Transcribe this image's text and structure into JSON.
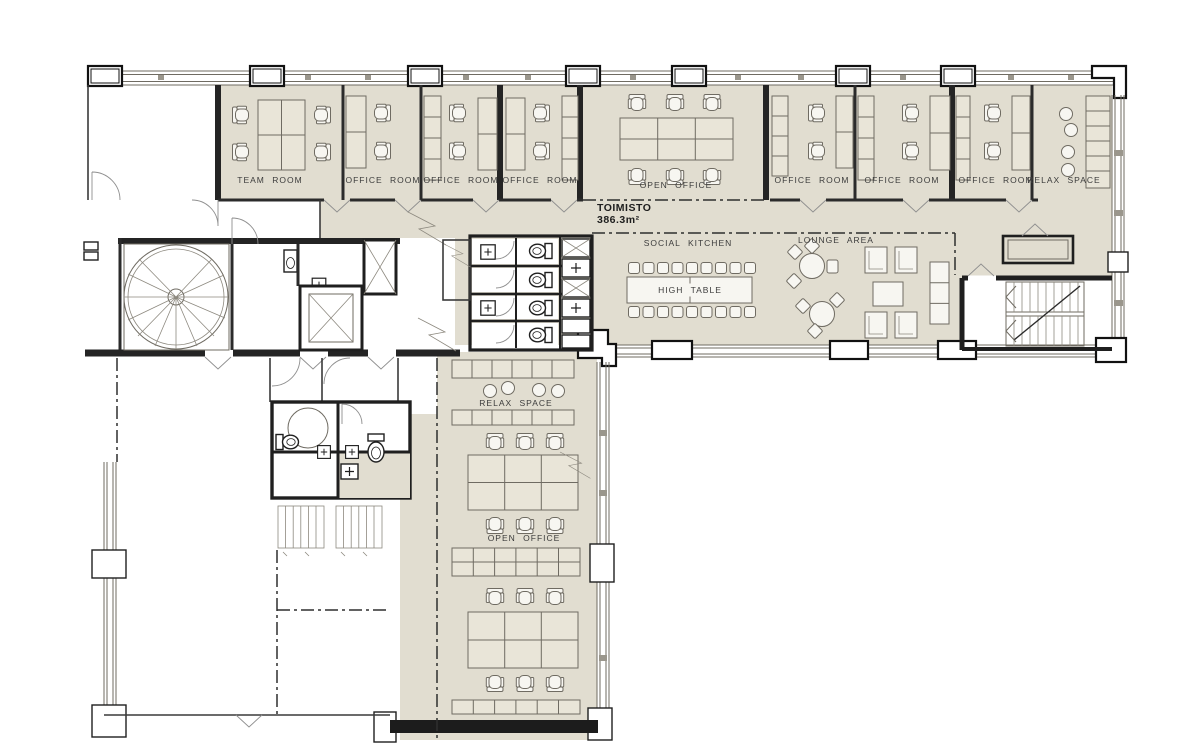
{
  "plan": {
    "title_block": {
      "name": "TOIMISTO",
      "area": "386.3m²"
    },
    "labels": {
      "team_room": "TEAM ROOM",
      "office_room": "OFFICE ROOM",
      "open_office": "OPEN OFFICE",
      "relax_space": "RELAX SPACE",
      "social_kitchen": "SOCIAL KITCHEN",
      "high_table": "HIGH TABLE",
      "lounge_area": "LOUNGE AREA"
    },
    "colors": {
      "floor_fill": "#e1ddd0",
      "furniture_fill": "#e9e5d8",
      "wall": "#1f1f1f",
      "thin_line": "#6f6b62",
      "background": "#ffffff"
    }
  }
}
